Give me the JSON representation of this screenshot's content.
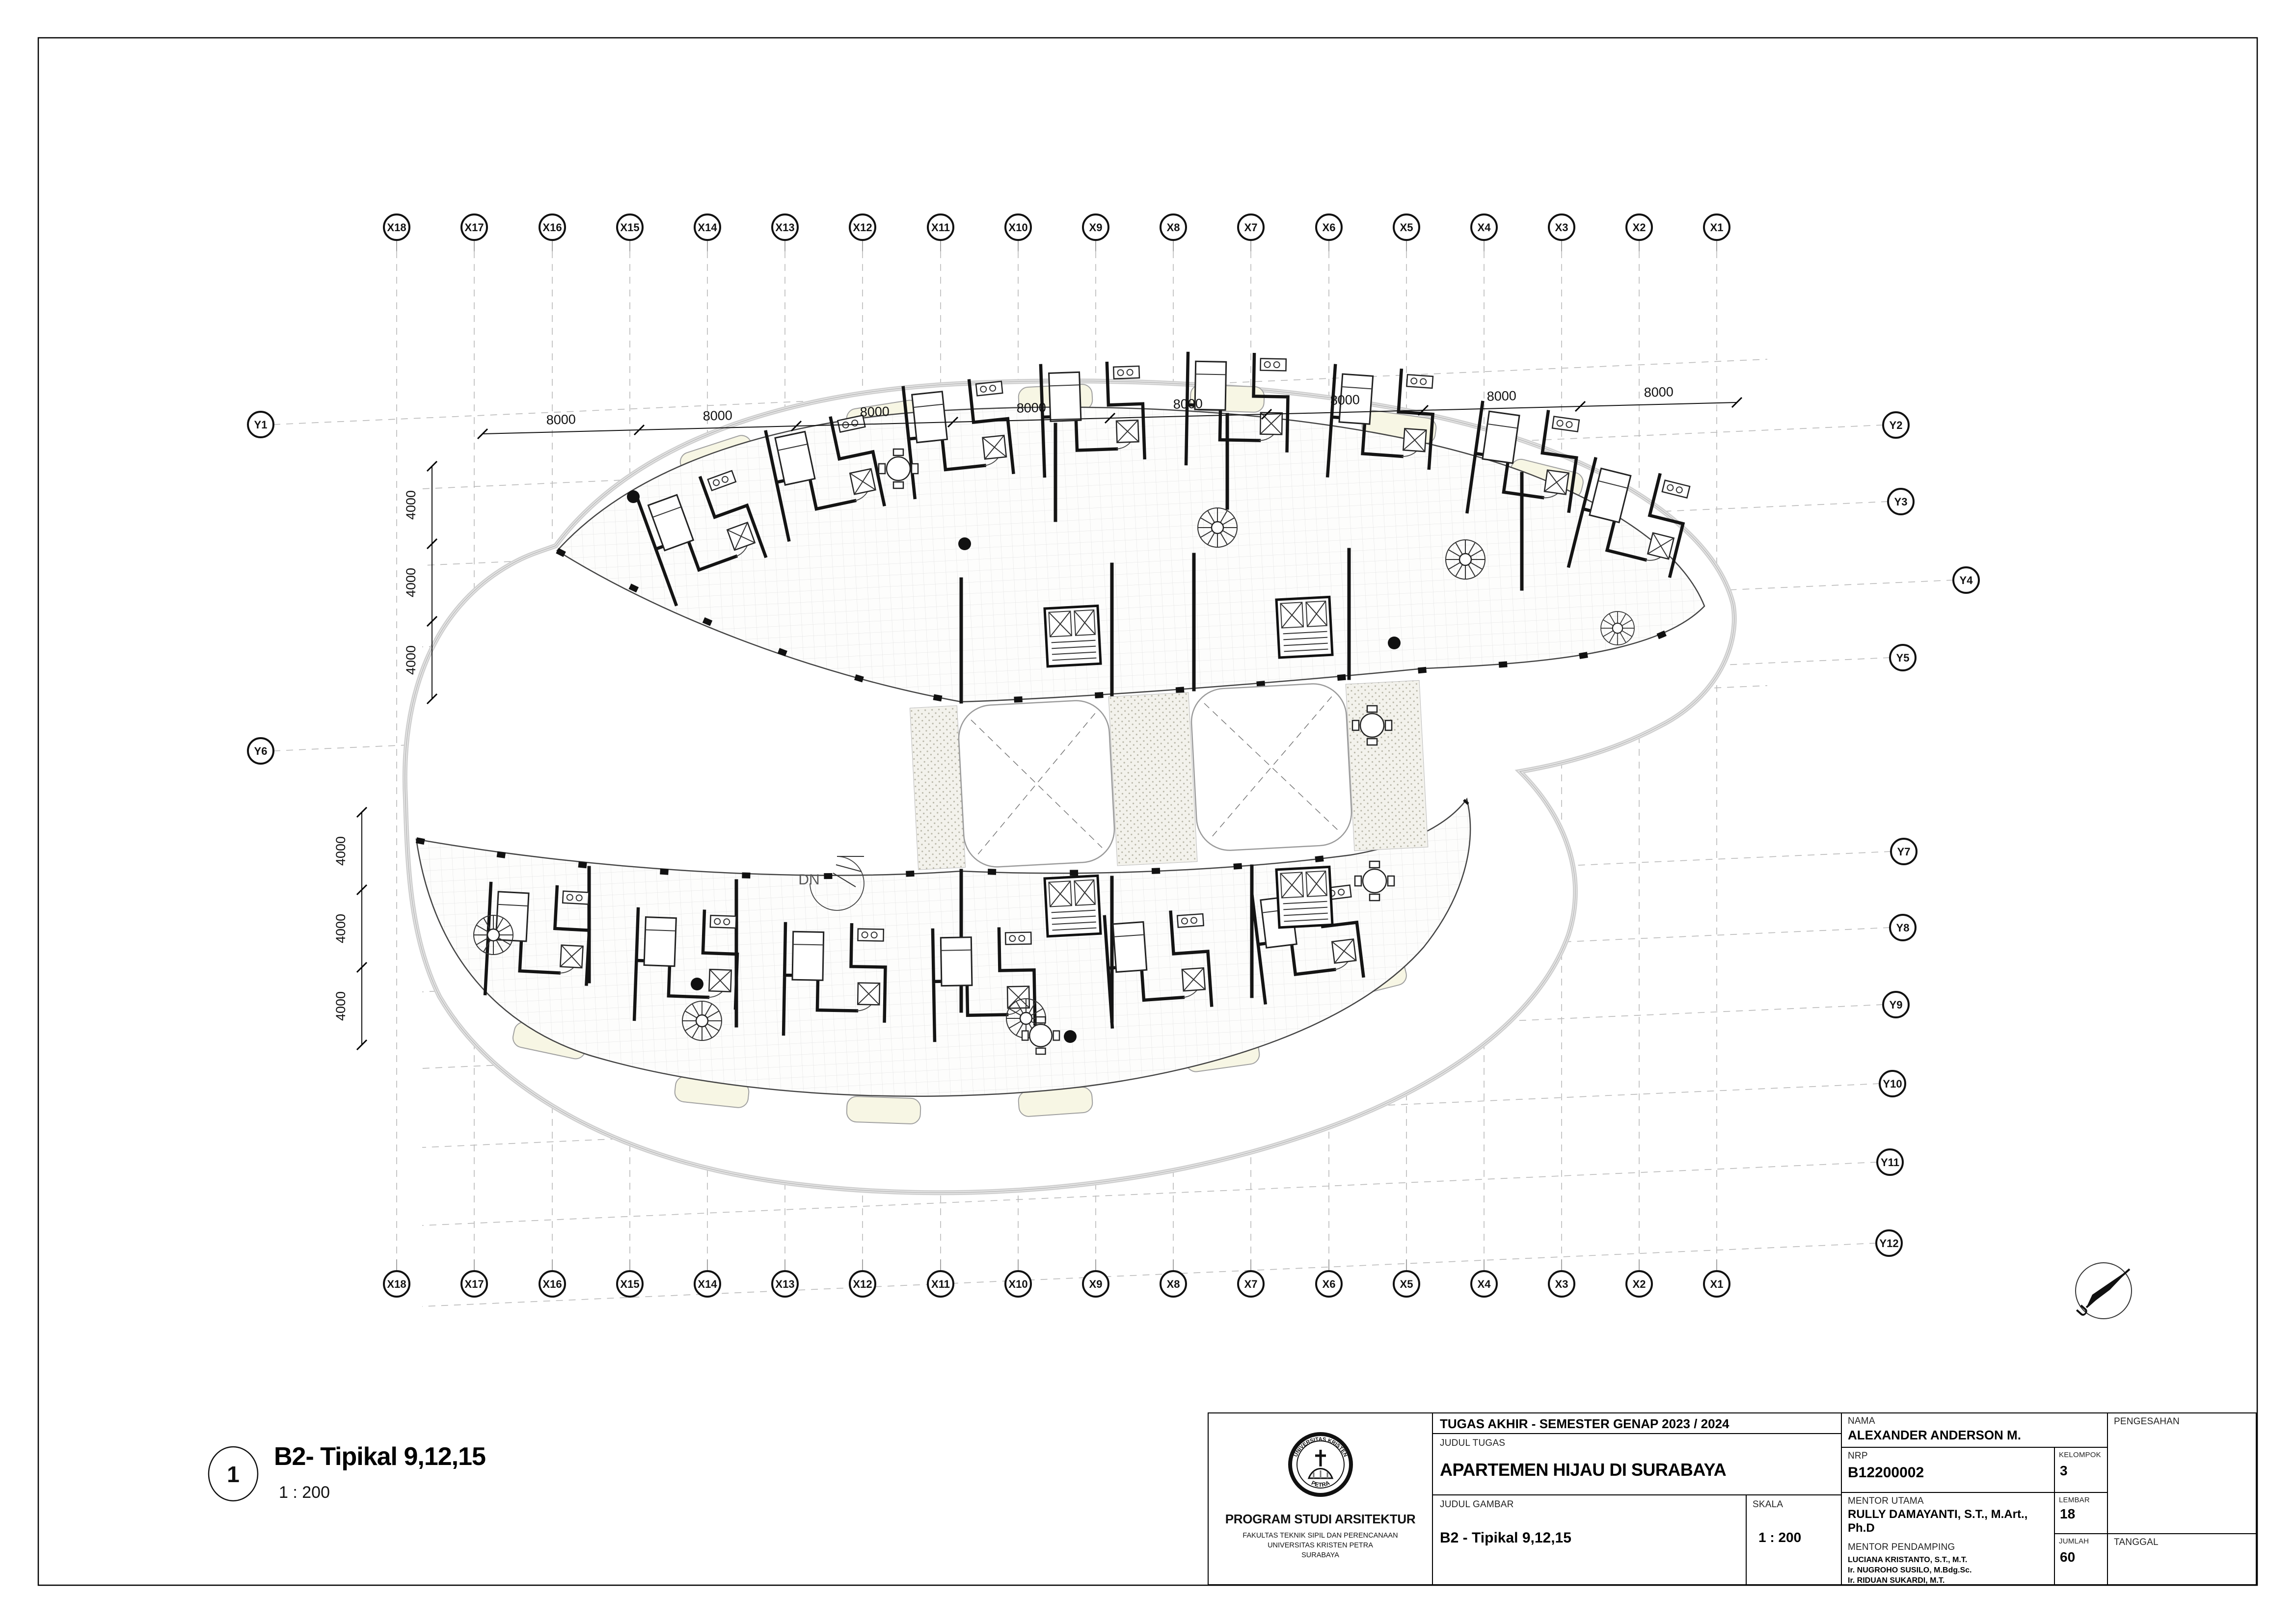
{
  "sheet": {
    "drawing_number": "1",
    "drawing_title": "B2- Tipikal 9,12,15",
    "drawing_scale": "1 : 200",
    "dn_label": "DN",
    "north_label": "U"
  },
  "grid": {
    "x_labels": [
      "X18",
      "X17",
      "X16",
      "X15",
      "X14",
      "X13",
      "X12",
      "X11",
      "X10",
      "X9",
      "X8",
      "X7",
      "X6",
      "X5",
      "X4",
      "X3",
      "X2",
      "X1"
    ],
    "y_left_labels": [
      "Y1",
      "Y6"
    ],
    "y_right_labels": [
      "Y2",
      "Y3",
      "Y4",
      "Y5",
      "Y7",
      "Y8",
      "Y9",
      "Y10",
      "Y11",
      "Y12"
    ],
    "dim_top": [
      "8000",
      "8000",
      "8000",
      "8000",
      "8000",
      "8000",
      "8000",
      "8000"
    ],
    "dim_left_upper": [
      "4000",
      "4000",
      "4000"
    ],
    "dim_left_lower": [
      "4000",
      "4000",
      "4000"
    ]
  },
  "title_block": {
    "header": "TUGAS AKHIR - SEMESTER GENAP 2023 / 2024",
    "labels": {
      "judul_tugas": "JUDUL TUGAS",
      "judul_gambar": "JUDUL GAMBAR",
      "skala": "SKALA",
      "nama": "NAMA",
      "nrp": "NRP",
      "kelompok": "KELOMPOK",
      "mentor_utama": "MENTOR UTAMA",
      "mentor_pendamping": "MENTOR PENDAMPING",
      "lembar": "LEMBAR",
      "jumlah": "JUMLAH",
      "pengesahan": "PENGESAHAN",
      "tanggal": "TANGGAL"
    },
    "values": {
      "judul_tugas": "APARTEMEN HIJAU DI SURABAYA",
      "judul_gambar": "B2 - Tipikal 9,12,15",
      "skala": "1 : 200",
      "nama": "ALEXANDER ANDERSON M.",
      "nrp": "B12200002",
      "kelompok": "3",
      "mentor_utama": "RULLY DAMAYANTI, S.T., M.Art., Ph.D",
      "mentor_pendamping": [
        "LUCIANA KRISTANTO, S.T., M.T.",
        "Ir. NUGROHO SUSILO, M.Bdg.Sc.",
        "Ir. RIDUAN SUKARDI, M.T."
      ],
      "lembar": "18",
      "jumlah": "60"
    },
    "institution": {
      "program": "PROGRAM STUDI ARSITEKTUR",
      "faculty": "FAKULTAS TEKNIK SIPIL DAN PERENCANAAN",
      "university": "UNIVERSITAS KRISTEN PETRA",
      "city": "SURABAYA",
      "seal_top": "UNIVERSITAS KRISTEN",
      "seal_bottom": "PETRA"
    }
  },
  "colors": {
    "ink": "#111111",
    "grid": "#b9b9b9",
    "blob": "#c9c9c9",
    "balcony": "#f7f6e4",
    "stipple_bg": "#f3f2ec"
  }
}
